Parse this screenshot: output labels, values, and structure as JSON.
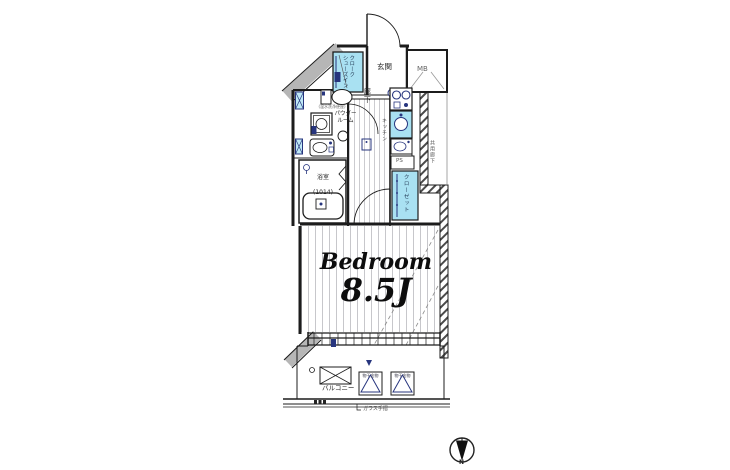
{
  "plan": {
    "rooms": {
      "entrance": "玄関",
      "shoe_closet": "シューズインクローク",
      "meter_box": "MB",
      "corridor": "廊下",
      "powder_room": "パウダールーム",
      "toilet_note": "(温水洗浄便座)",
      "bathroom": "浴室",
      "bathroom_size": "(1014)",
      "kitchen": "キッチン",
      "pipe_space": "PS",
      "closet": "クローゼット",
      "common_corridor": "共用廊下",
      "bedroom": {
        "name": "Bedroom",
        "size": "8.5J"
      },
      "balcony": "バルコニー"
    },
    "annotations": {
      "glass_rail": "ガラス手摺",
      "laundry_bracket": "物干金物"
    },
    "compass": {
      "north": "N"
    },
    "colors": {
      "room_highlight": "#a9e1f2",
      "fixture_navy": "#27357e",
      "wall_gray": "#b6b6b6"
    }
  }
}
